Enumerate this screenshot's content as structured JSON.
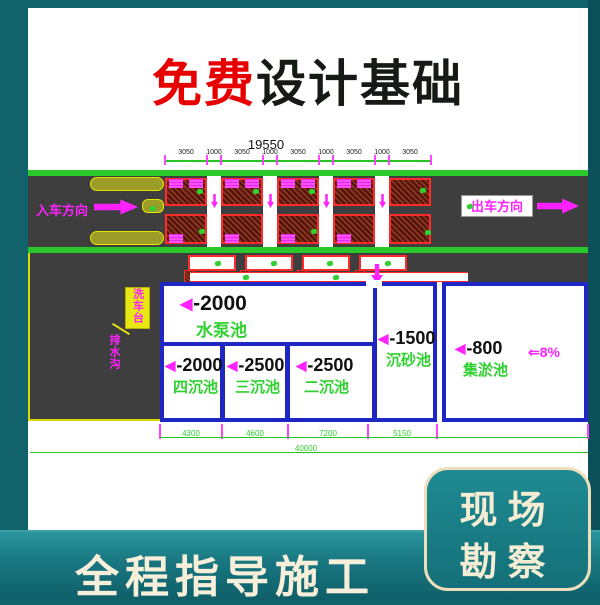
{
  "title": {
    "highlight": "免费",
    "rest": "设计基础"
  },
  "banner": {
    "left_text": "全程指导施工"
  },
  "side_panel": {
    "line1": "现场",
    "line2": "勘察"
  },
  "drawing": {
    "overall_dim": "19550",
    "top_dims": [
      "3050",
      "1000",
      "3050",
      "1000",
      "3050",
      "1000",
      "3050",
      "1000",
      "3050"
    ],
    "entry_label": "入车方向",
    "exit_label": "出车方向",
    "slope_label": "⇐8%",
    "callout_box_label": "洗车台",
    "callout_leader_label": "排水沟",
    "triangle_icon": "◀",
    "pools": [
      {
        "depth": "-2000",
        "name": "水泵池"
      },
      {
        "depth": "-2000",
        "name": "四沉池"
      },
      {
        "depth": "-2500",
        "name": "三沉池"
      },
      {
        "depth": "-2500",
        "name": "二沉池"
      },
      {
        "depth": "-1500",
        "name": "沉砂池"
      },
      {
        "depth": "-800",
        "name": "集淤池"
      }
    ],
    "bottom_dims": [
      "4300",
      "4600",
      "7200",
      "5150"
    ],
    "total_dim": "40000"
  },
  "colors": {
    "accent_red": "#e60000",
    "teal_bg": "#11626b",
    "cad_green": "#2bc82b",
    "cad_magenta": "#ff22ff",
    "pool_blue": "#1e27c4",
    "road_gray": "#3e3e3e",
    "cream_text": "#f5ecd4"
  }
}
